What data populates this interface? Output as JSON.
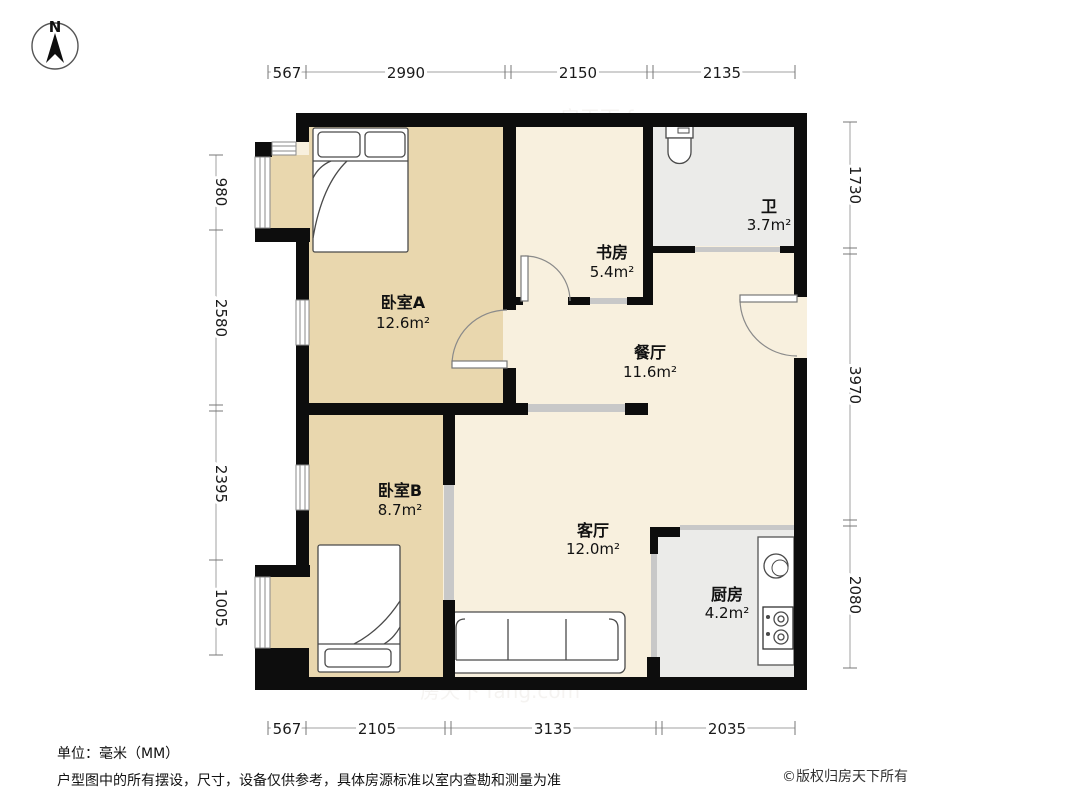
{
  "compass": {
    "label": "N"
  },
  "dimensions": {
    "unit": "mm",
    "top": [
      "567",
      "2990",
      "2150",
      "2135"
    ],
    "bottom": [
      "567",
      "2105",
      "3135",
      "2035"
    ],
    "left": [
      "980",
      "2580",
      "2395",
      "1005"
    ],
    "right": [
      "1730",
      "3970",
      "2080"
    ]
  },
  "rooms": [
    {
      "name": "卧室A",
      "area": "12.6m²"
    },
    {
      "name": "书房",
      "area": "5.4m²"
    },
    {
      "name": "卫",
      "area": "3.7m²"
    },
    {
      "name": "餐厅",
      "area": "11.6m²"
    },
    {
      "name": "卧室B",
      "area": "8.7m²"
    },
    {
      "name": "客厅",
      "area": "12.0m²"
    },
    {
      "name": "厨房",
      "area": "4.2m²"
    }
  ],
  "footer": {
    "unit_note": "单位：毫米（MM）",
    "disclaimer": "户型图中的所有摆设，尺寸，设备仅供参考，具体房源标准以室内查勘和测量为准",
    "copyright": "©版权归房天下所有"
  },
  "watermark": "房天下 fang.com",
  "colors": {
    "wall": "#0d0d0d",
    "bedroom_floor": "#e9d7ae",
    "common_floor": "#f8f0de",
    "wet_floor": "#ebebe9",
    "sliding_door": "#c8c8c8",
    "dimension_line": "#a0a0a0"
  }
}
